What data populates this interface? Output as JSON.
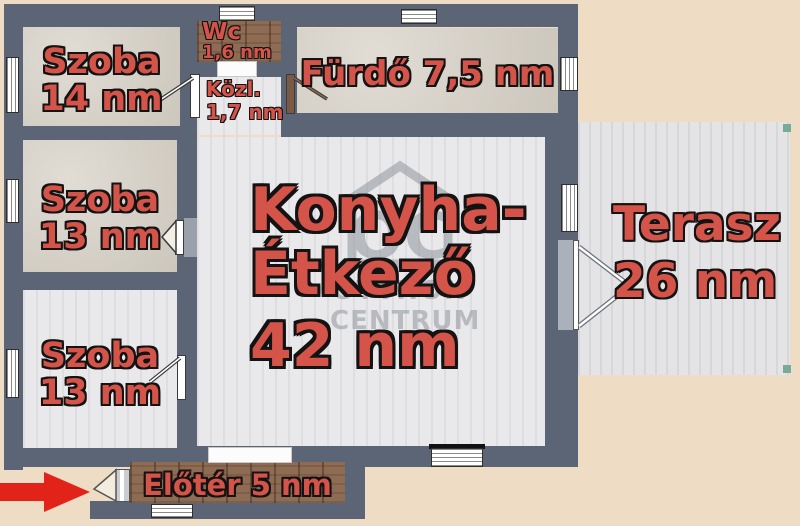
{
  "plan_title": "apartment-floor-plan",
  "colors": {
    "background": "#eedcc4",
    "wall": "#5b6575",
    "room_label_fill": "#d5544a",
    "room_label_outline": "#131313",
    "entrance_arrow": "#e2231a",
    "wood_floor": "#8e6c54",
    "watermark_gray": "#8f959b"
  },
  "rooms": {
    "szoba_14": {
      "name": "Szoba",
      "area": "14 nm"
    },
    "szoba_13_a": {
      "name": "Szoba",
      "area": "13 nm"
    },
    "szoba_13_b": {
      "name": "Szoba",
      "area": "13 nm"
    },
    "wc": {
      "name": "Wc",
      "area": "1,6 nm"
    },
    "kozlekedo": {
      "name": "Közl.",
      "area": "1,7 nm"
    },
    "furdo": {
      "label": "Fürdő 7,5 nm"
    },
    "konyha_etkezo": {
      "line1": "Konyha-",
      "line2": "Étkező",
      "area": "42 nm"
    },
    "terasz": {
      "name": "Terasz",
      "area": "26 nm"
    },
    "eloter": {
      "label": "Előtér 5 nm"
    }
  },
  "watermark": {
    "monogram": "OC",
    "line1": "OTTHON",
    "line2": "CENTRUM"
  }
}
